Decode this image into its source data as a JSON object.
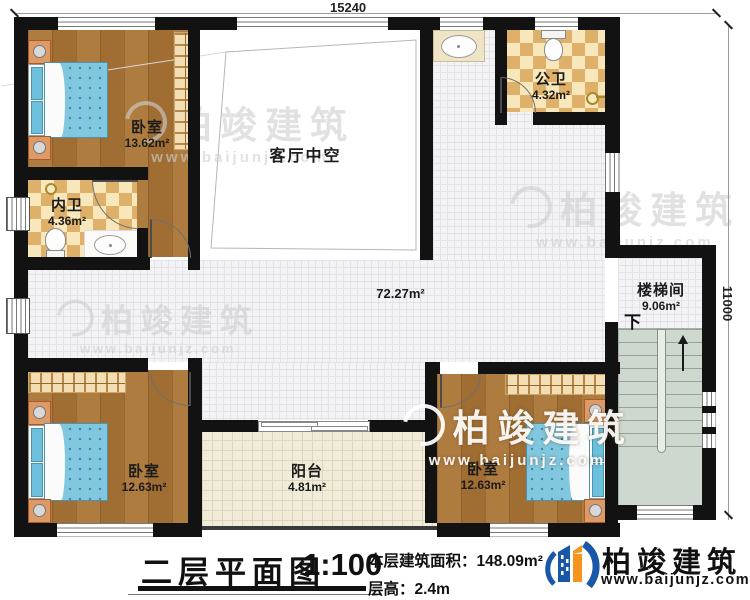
{
  "dimensions": {
    "width": "15240",
    "height": "11000"
  },
  "rooms": {
    "bedroom_tl": {
      "name": "卧室",
      "area": "13.62m²"
    },
    "bath_inner": {
      "name": "内卫",
      "area": "4.36m²"
    },
    "living_void": {
      "name": "客厅中空"
    },
    "bath_public": {
      "name": "公卫",
      "area": "4.32m²"
    },
    "hall": {
      "area": "72.27m²"
    },
    "stairwell": {
      "name": "楼梯间",
      "area": "9.06m²",
      "down_label": "下"
    },
    "bedroom_bl": {
      "name": "卧室",
      "area": "12.63m²"
    },
    "balcony": {
      "name": "阳台",
      "area": "4.81m²"
    },
    "bedroom_br": {
      "name": "卧室",
      "area": "12.63m²"
    }
  },
  "title_block": {
    "title": "二层平面图",
    "scale": "1:100",
    "floor_area_label": "本层建筑面积：",
    "floor_area_value": "148.09m²",
    "floor_height_label": "层高：",
    "floor_height_value": "2.4m"
  },
  "brand": {
    "name": "柏竣建筑",
    "website": "www.baijunjz.com"
  },
  "watermark": {
    "name": "柏竣建筑",
    "website": "www.baijunjz.com"
  },
  "colors": {
    "wall": "#121212",
    "wood": "#a9763b",
    "checker_light": "#f7e7bb",
    "checker_dark": "#dfb069",
    "brand_blue": "#1a57a8",
    "brand_orange": "#f7941d"
  }
}
